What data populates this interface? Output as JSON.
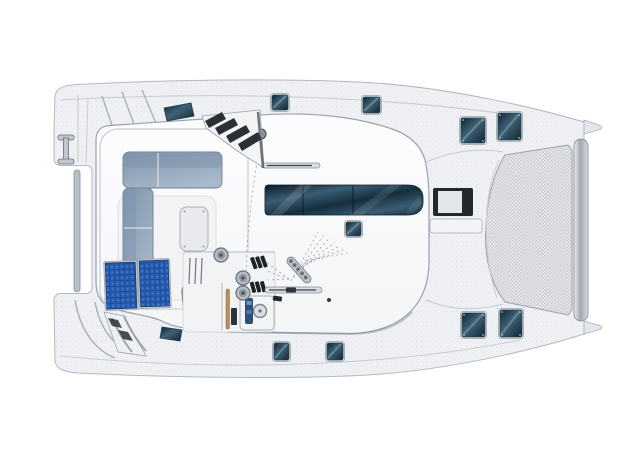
{
  "diagram": {
    "label": "catamaran-deck-plan-top-view",
    "orientation": "bow-right-stern-left",
    "visible_text": ""
  },
  "palette": {
    "background": "#ffffff",
    "hull": "#eef0f3",
    "hull_stroke": "#b3b9c1",
    "deck_line": "#c7cdd3",
    "pod": "#fafbfc",
    "pod_stroke": "#9aa2ab",
    "pod_shadow": "#8a929b",
    "window_deep": "#0c1b26",
    "window_mid": "#3a5d73",
    "window_low": "#152e3d",
    "hatch_hi": "#3e6277",
    "hatch_lo": "#10242f",
    "hatch_frame": "#e6e9ec",
    "hatch_frame_stroke": "#9aa1a8",
    "cushion": "#a9b9cb",
    "cushion_dark": "#7f94ac",
    "solar_base": "#1d4a94",
    "solar_cell": "#2a62b8",
    "metal": "#c2c7cd",
    "metal_dark": "#6a7077",
    "liferaft_hi": "#a6adb4",
    "liferaft_lo": "#7b828a",
    "wood": "#b8915a",
    "mesh_base": "#ededef",
    "mesh_dot": "#c6cad0",
    "step_dark": "#2a3036",
    "rail": "#d9dde1"
  },
  "components": [
    "port-hull",
    "starboard-hull",
    "stern-transom-steps",
    "boarding-ladder",
    "aft-crossbar",
    "cockpit",
    "l-shaped-settee",
    "cockpit-table",
    "solar-panel-pair",
    "liferaft-canister",
    "helm-console",
    "steering-wheel",
    "winches",
    "rope-clutches",
    "deck-organizer",
    "halyard-fan-lines",
    "grab-rails",
    "coachroof",
    "salon-window-band",
    "roof-hatch",
    "coachroof-front-steps",
    "foredeck",
    "deck-hatches",
    "trampoline",
    "bow-crossbeam",
    "bow-tips"
  ],
  "hatches": [
    {
      "name": "side-deck-hatch-aft-top",
      "x": 272,
      "y": 95,
      "w": 16,
      "h": 15,
      "screws": false
    },
    {
      "name": "side-deck-hatch-fwd-top",
      "x": 363,
      "y": 97,
      "w": 17,
      "h": 16,
      "screws": false
    },
    {
      "name": "foredeck-hatch-top-left",
      "x": 461,
      "y": 118,
      "w": 24,
      "h": 25,
      "screws": true
    },
    {
      "name": "foredeck-hatch-top-right",
      "x": 498,
      "y": 113,
      "w": 23,
      "h": 27,
      "screws": true
    },
    {
      "name": "foredeck-hatch-bottom-left",
      "x": 462,
      "y": 313,
      "w": 23,
      "h": 24,
      "screws": true
    },
    {
      "name": "foredeck-hatch-bottom-right",
      "x": 500,
      "y": 310,
      "w": 22,
      "h": 27,
      "screws": true
    },
    {
      "name": "side-deck-hatch-aft-bottom",
      "x": 274,
      "y": 343,
      "w": 15,
      "h": 17,
      "screws": false
    },
    {
      "name": "side-deck-hatch-fwd-bottom",
      "x": 327,
      "y": 343,
      "w": 16,
      "h": 17,
      "screws": false
    },
    {
      "name": "coachroof-hatch",
      "x": 346,
      "y": 222,
      "w": 15,
      "h": 14,
      "screws": false
    }
  ],
  "solar_panels": [
    {
      "name": "solar-panel-left",
      "x": 106,
      "y": 262,
      "w": 30,
      "h": 46
    },
    {
      "name": "solar-panel-right",
      "x": 140,
      "y": 261,
      "w": 29,
      "h": 46
    }
  ],
  "rigging": {
    "fan_line_count": 7,
    "clutch_line_count": 3,
    "winch_positions": [
      [
        221,
        255
      ],
      [
        243,
        278
      ],
      [
        243,
        293
      ],
      [
        261,
        134
      ]
    ]
  }
}
